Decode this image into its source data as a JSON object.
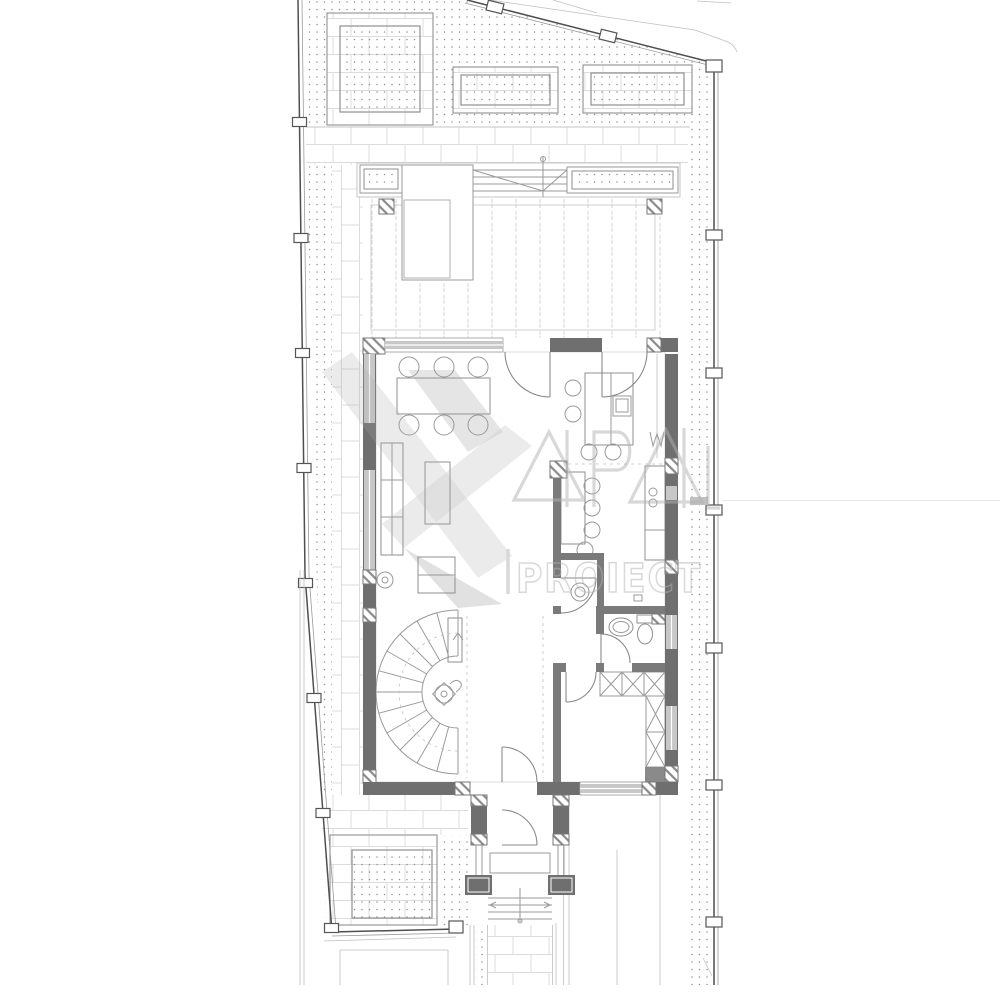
{
  "watermark": {
    "logo_text": "4P4L",
    "brand_text": "PROIECT"
  },
  "palette": {
    "paper": "#ffffff",
    "wall": "#6f6f6f",
    "wall-medium": "#7a7a7a",
    "window": "#c7c7c7",
    "line": "#9a9a9a",
    "line-light": "#c9c9c9",
    "dot": "#8f8f8f",
    "pave": "#dcdcdc",
    "deck": "#d4d4d4",
    "hatch": "#8a8a8a",
    "watermark": "#b2b2b2"
  },
  "legend": {
    "dining_chairs": 6,
    "kitchen_stools": 4,
    "breakfast_chairs": 4,
    "planting_beds": 4,
    "terrace_planters": 2,
    "wardrobe_modules": 5,
    "entrance_steps": 4,
    "terrace_steps": 4,
    "fence_posts": 19
  }
}
